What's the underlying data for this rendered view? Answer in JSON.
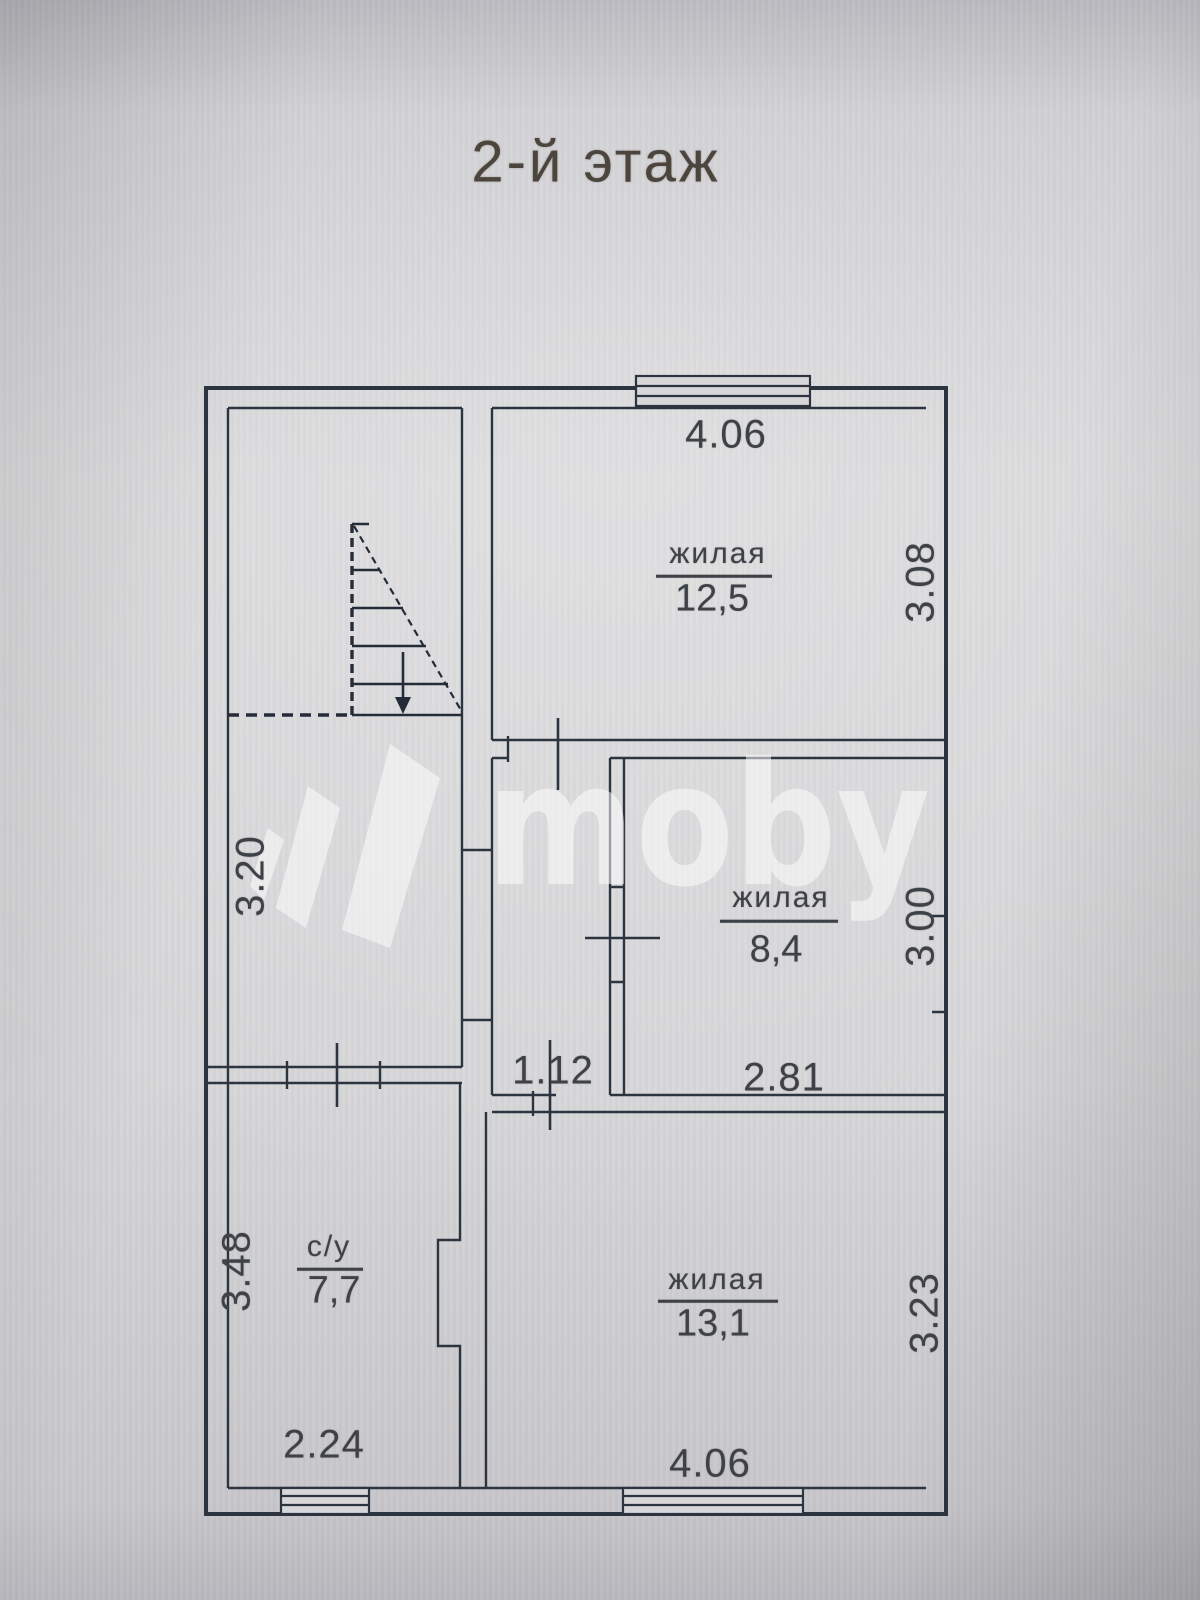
{
  "title": "2-й этаж",
  "watermark": {
    "text": "moby"
  },
  "rooms": {
    "living_125": {
      "label": "жилая",
      "area": "12,5"
    },
    "living_84": {
      "label": "жилая",
      "area": "8,4"
    },
    "living_131": {
      "label": "жилая",
      "area": "13,1"
    },
    "bathroom": {
      "label": "с/у",
      "area": "7,7"
    }
  },
  "dimensions": {
    "top_width": "4.06",
    "living125_height": "3.08",
    "living84_height": "3.00",
    "living84_width": "2.81",
    "corridor_width": "1.12",
    "living131_height": "3.23",
    "living131_width": "4.06",
    "hall_height": "3.20",
    "bathroom_height": "3.48",
    "bathroom_width": "2.24"
  }
}
